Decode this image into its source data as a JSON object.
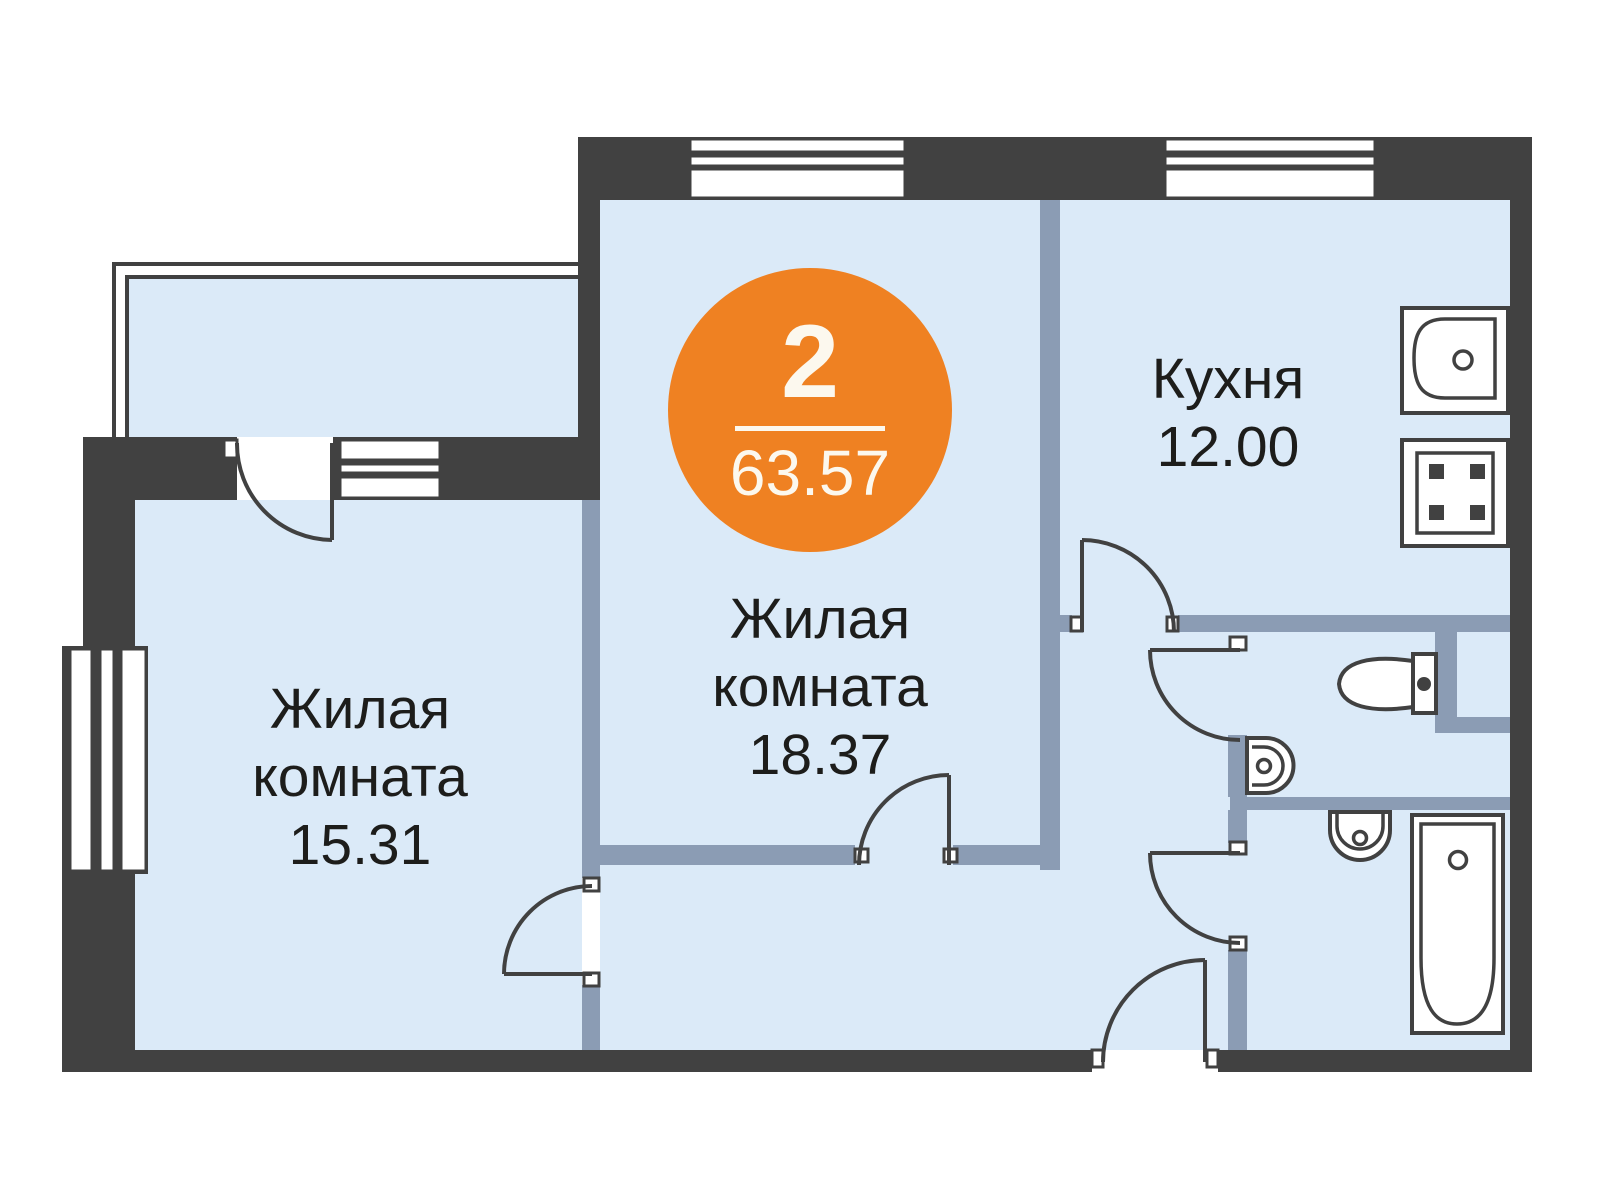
{
  "badge": {
    "rooms_count": "2",
    "total_area": "63.57"
  },
  "rooms": {
    "living_main": {
      "line1": "Жилая",
      "line2": "комната",
      "area": "18.37"
    },
    "living_second": {
      "line1": "Жилая",
      "line2": "комната",
      "area": "15.31"
    },
    "kitchen": {
      "name": "Кухня",
      "area": "12.00"
    }
  },
  "fixtures": {
    "kitchen_sink": "kitchen-sink",
    "stove": "stove-4-burners",
    "toilet": "toilet",
    "wc_washbasin": "washbasin",
    "bath_washbasin": "small-washbasin",
    "bathtub": "bathtub"
  },
  "colors": {
    "wall": "#414141",
    "partition": "#8b9cb4",
    "floor": "#dbeaf8",
    "accent": "#ef8122",
    "label": "#1d1d1b",
    "badge_text": "#fcf8ee"
  }
}
